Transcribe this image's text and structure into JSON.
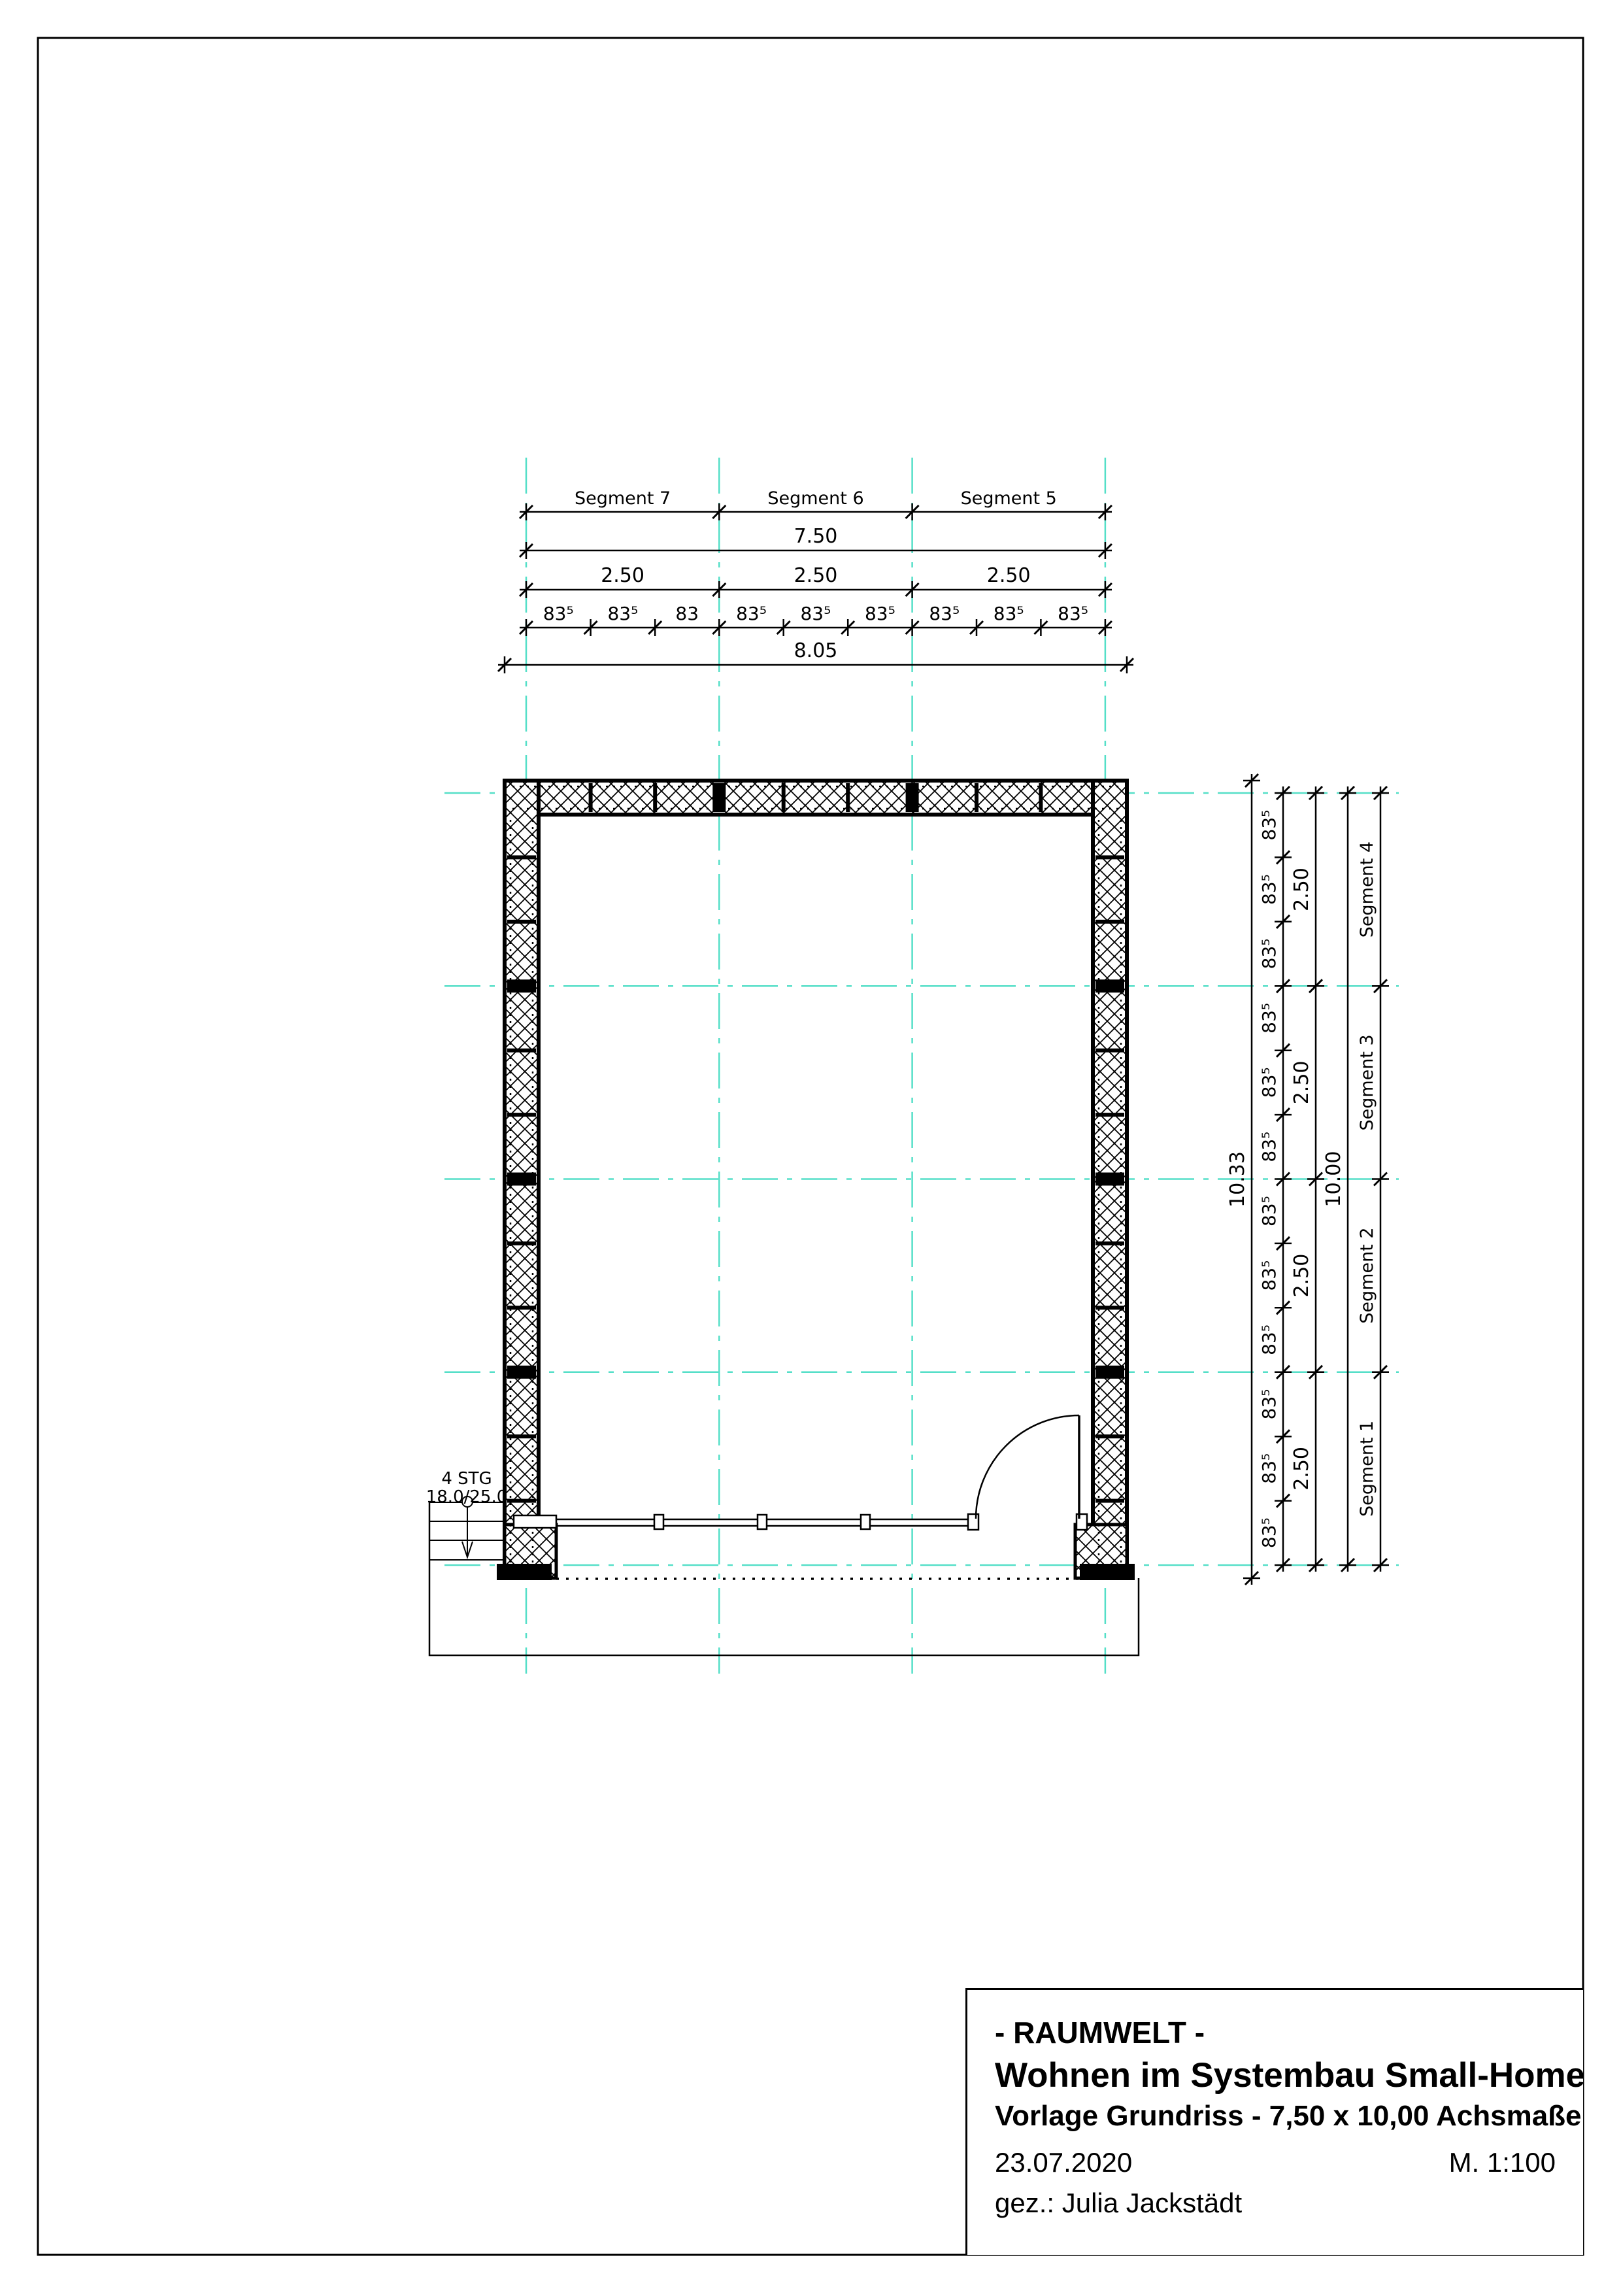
{
  "colors": {
    "grid": "#55dfc8",
    "ink": "#000000"
  },
  "dims": {
    "top": {
      "segments": [
        "Segment 7",
        "Segment 6",
        "Segment 5"
      ],
      "axis_total": "7.50",
      "bays": [
        "2.50",
        "2.50",
        "2.50"
      ],
      "chain": [
        "83⁵",
        "83⁵",
        "83",
        "83⁵",
        "83⁵",
        "83⁵",
        "83⁵",
        "83⁵",
        "83⁵"
      ],
      "outer_total": "8.05"
    },
    "right": {
      "outer_total": "10.33",
      "chain": [
        "83⁵",
        "83⁵",
        "83⁵",
        "83⁵",
        "83⁵",
        "83⁵",
        "83⁵",
        "83⁵",
        "83⁵",
        "83⁵",
        "83⁵",
        "83⁵"
      ],
      "bays": [
        "2.50",
        "2.50",
        "2.50",
        "2.50"
      ],
      "axis_total": "10.00",
      "segments": [
        "Segment 4",
        "Segment 3",
        "Segment 2",
        "Segment 1"
      ]
    }
  },
  "stairs_label": {
    "line1": "4 STG",
    "line2": "18.0/25.0"
  },
  "title_block": {
    "line1": "- RAUMWELT -",
    "line2": "Wohnen im Systembau Small-Home",
    "line3": "Vorlage Grundriss - 7,50 x 10,00 Achsmaße",
    "date": "23.07.2020",
    "scale": "M. 1:100",
    "author": "gez.: Julia Jackstädt"
  }
}
